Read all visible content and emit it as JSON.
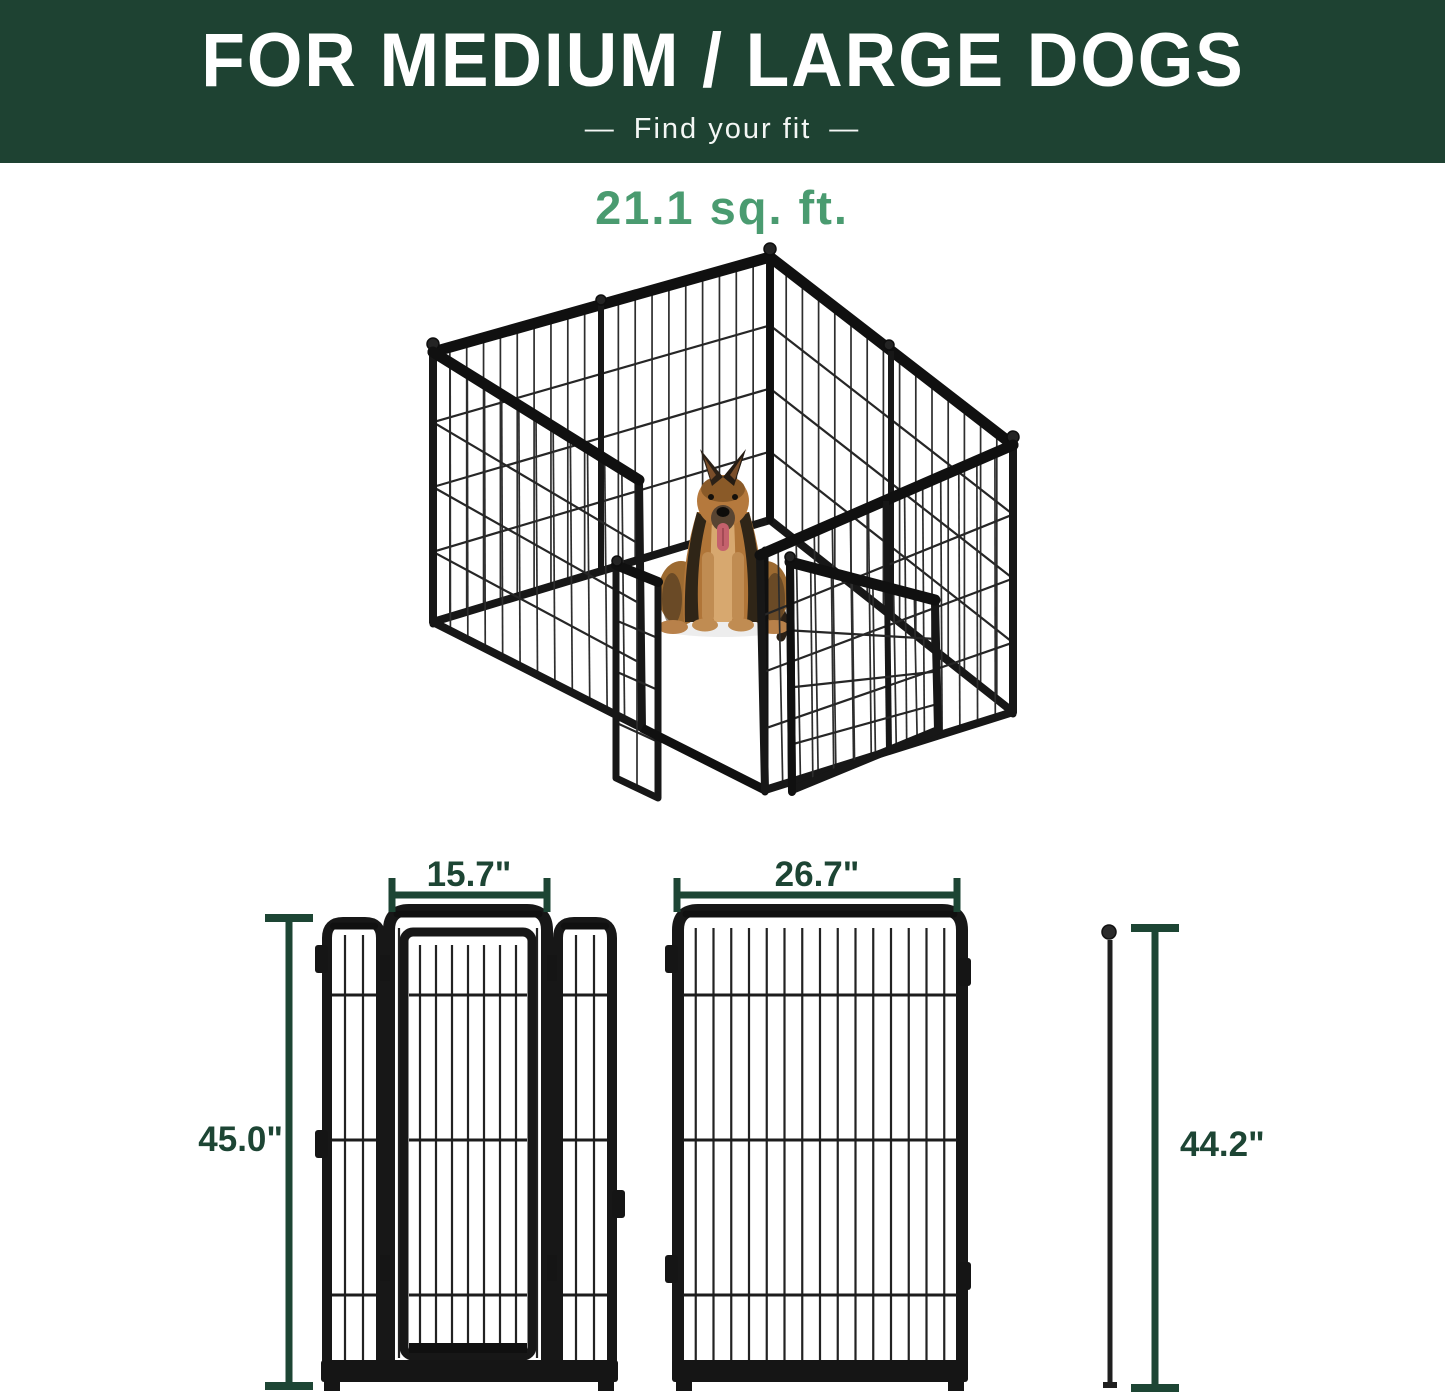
{
  "banner": {
    "title": "FOR MEDIUM / LARGE DOGS",
    "subtitle": "Find your fit",
    "dash": "—"
  },
  "area_label": "21.1 sq. ft.",
  "dimensions": {
    "door_panel_width": "15.7\"",
    "large_panel_width": "26.7\"",
    "door_panel_height": "45.0\"",
    "large_panel_height": "44.2\""
  },
  "colors": {
    "banner_background": "#1E4232",
    "accent_green": "#4A9B70",
    "dimension_green": "#1D4534",
    "frame_black": "#171717"
  }
}
